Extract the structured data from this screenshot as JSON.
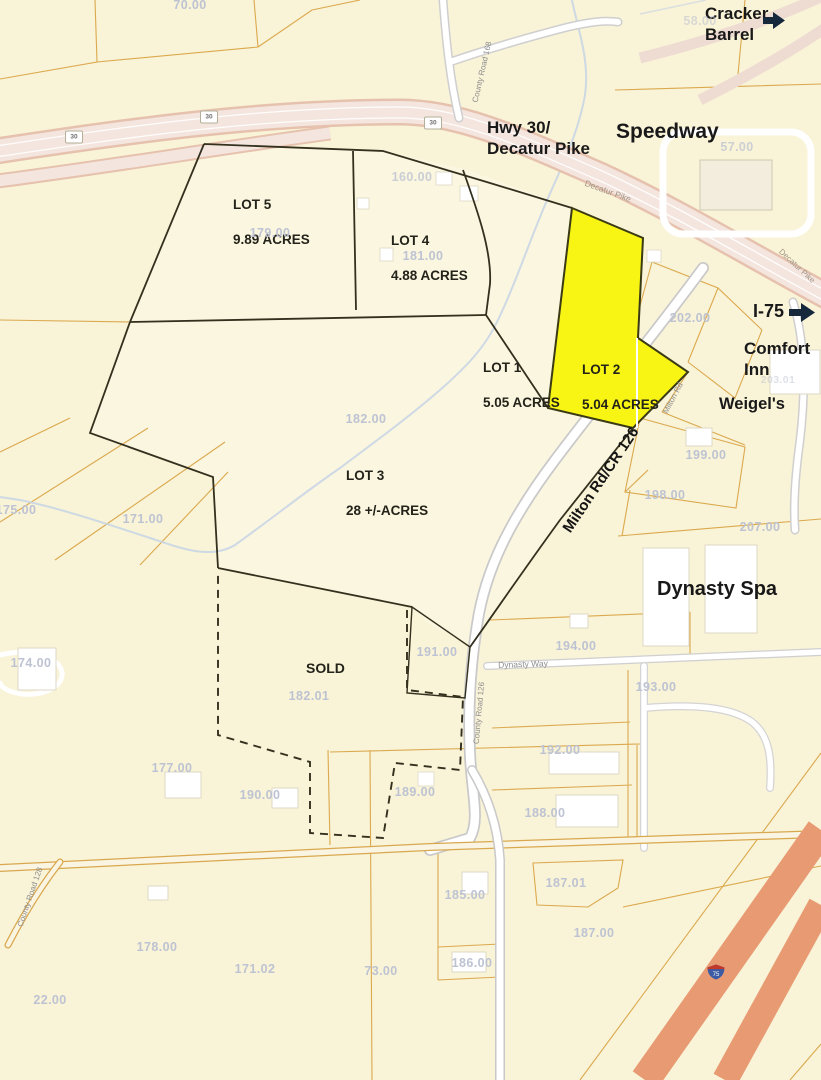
{
  "landmarks": {
    "cracker_barrel": "Cracker\nBarrel",
    "speedway": "Speedway",
    "hwy30": "Hwy 30/\nDecatur Pike",
    "i75": "I-75",
    "comfort_inn": "Comfort\nInn",
    "weigels": "Weigel's",
    "dynasty_spa": "Dynasty Spa"
  },
  "lots": {
    "lot5": {
      "name": "LOT 5",
      "acres": "9.89 ACRES"
    },
    "lot4": {
      "name": "LOT 4",
      "acres": "4.88 ACRES"
    },
    "lot1": {
      "name": "LOT 1",
      "acres": "5.05 ACRES"
    },
    "lot2": {
      "name": "LOT 2",
      "acres": "5.04 ACRES"
    },
    "lot3": {
      "name": "LOT 3",
      "acres": "28 +/-ACRES"
    },
    "sold": {
      "name": "SOLD"
    }
  },
  "roads": {
    "hwy30_shield": "30",
    "county_road_168": "County Road 168",
    "decatur_pike": "Decatur Pike",
    "milton_rd_cr126": "Milton Rd/CR 126",
    "milton_rd": "Milton Rd",
    "county_road_126": "County Road 126",
    "dynasty_way": "Dynasty Way",
    "county_road_128": "County Road 128",
    "i75_shield": "75"
  },
  "parcels": {
    "p70": "70.00",
    "p58": "58.00",
    "p57": "57.00",
    "p160": "160.00",
    "p179": "179.00",
    "p181": "181.00",
    "p202": "202.00",
    "p203": "203.01",
    "p182": "182.00",
    "p175": "175.00",
    "p171": "171.00",
    "p199": "199.00",
    "p198": "198.00",
    "p207": "207.00",
    "p174": "174.00",
    "p194": "194.00",
    "p191": "191.00",
    "p193": "193.00",
    "p18201": "182.01",
    "p192": "192.00",
    "p177": "177.00",
    "p190": "190.00",
    "p189": "189.00",
    "p188": "188.00",
    "p185": "185.00",
    "p18701": "187.01",
    "p187": "187.00",
    "p186": "186.00",
    "p178": "178.00",
    "p17102": "171.02",
    "p73": "73.00",
    "p22": "22.00"
  },
  "colors": {
    "background": "#f9f3d7",
    "lot_highlight": "#f8f414",
    "lot_highlight_stroke": "#3a3a14",
    "interstate": "#e89a72",
    "highway_fill": "#f4e6df",
    "highway_casing": "#e6c2ae",
    "parcel_line": "#dba94e",
    "boundary": "#34301e",
    "creek": "#c5d3e5",
    "arrow": "#16283c"
  }
}
